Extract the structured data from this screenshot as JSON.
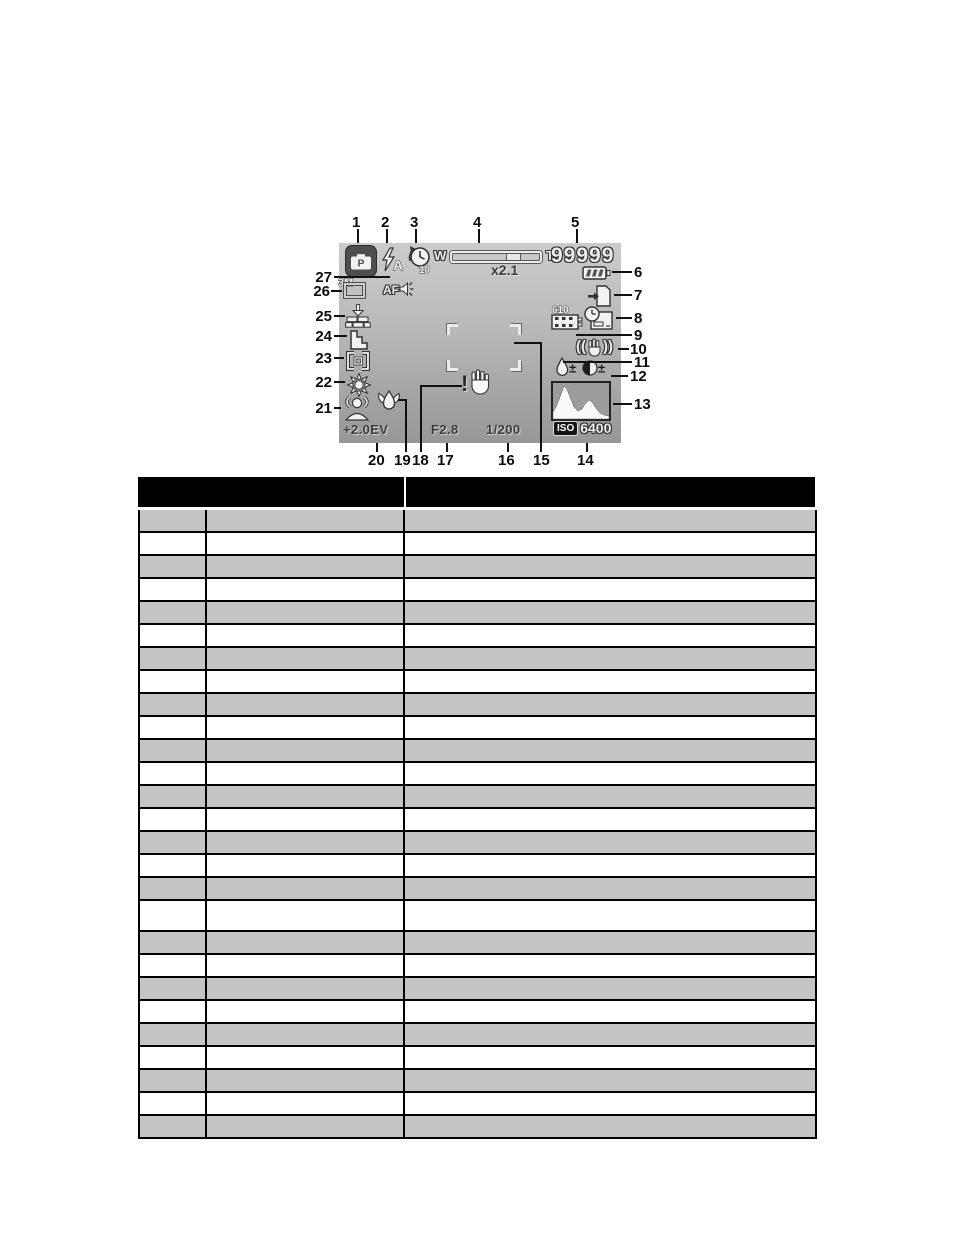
{
  "callouts": {
    "top": [
      "1",
      "2",
      "3",
      "4",
      "5"
    ],
    "left": [
      "27",
      "26",
      "25",
      "24",
      "23",
      "22",
      "21"
    ],
    "right": [
      "6",
      "7",
      "8",
      "9",
      "10",
      "11",
      "12",
      "13"
    ],
    "bottom": [
      "20",
      "19",
      "18",
      "17",
      "16",
      "15",
      "14"
    ]
  },
  "screen": {
    "mode_label": "P",
    "flash_label": "A",
    "timer_label": "10",
    "wide_label": "W",
    "tele_label": "T",
    "zoom_factor": "x2.1",
    "shots_remaining": "99999",
    "movie_time": "610",
    "plusminus": "±",
    "stab_open": "((",
    "stab_close": "))",
    "warning_mark": "!",
    "resolution_label": "3M",
    "af_label": "AF",
    "exposure_value": "+2.0EV",
    "aperture_value": "F2.8",
    "shutter_value": "1/200",
    "iso_label": "ISO",
    "iso_value": "6400",
    "icons": [
      "record-mode-icon",
      "flash-auto-icon",
      "self-timer-icon",
      "zoom-bar",
      "battery-full-icon",
      "storage-media-icon",
      "date-stamp-icon",
      "movie-remaining-icon",
      "stabilizer-icon",
      "saturation-icon",
      "contrast-icon",
      "histogram",
      "focus-frame",
      "shake-warning-icon",
      "macro-icon",
      "face-tracking-icon",
      "white-balance-icon",
      "metering-icon",
      "sharpness-icon",
      "quality-icon",
      "resolution-icon",
      "af-lamp-icon"
    ],
    "colors": {
      "lcd_gradient_top": "#cbcbcb",
      "lcd_gradient_bottom": "#979797",
      "icon_fill": "#ececec",
      "icon_stroke": "#333333",
      "mode_badge_bg": "#4e4e4e"
    }
  },
  "table": {
    "header": {
      "left_label": "",
      "right_label": ""
    },
    "row_count": 27,
    "columns": 3,
    "tall_row_index": 18,
    "colors": {
      "header_bg": "#000000",
      "odd_row": "#c4c4c4",
      "even_row": "#ffffff",
      "border": "#000000"
    }
  }
}
